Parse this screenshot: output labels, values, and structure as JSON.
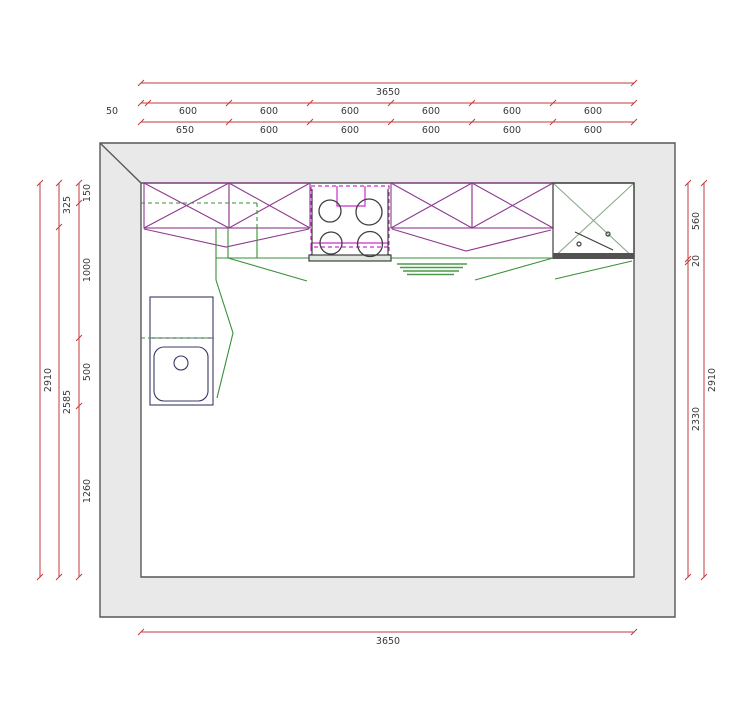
{
  "colors": {
    "dimension": "#c23b3b",
    "dim_text": "#3a3a3a",
    "wall_fill": "#e9e9e9",
    "wall_edge": "#575757",
    "cabinet": "#8e3a8e",
    "hood": "#cc2dcc",
    "fixture_green": "#3a8f3a",
    "hatch_green": "#4a9a4a",
    "tall_x_green": "#8aab8a",
    "appliance_dark": "#3f3f3f",
    "sink_navy": "#383864"
  },
  "dims": {
    "top_overall": "3650",
    "top_row2": [
      "50",
      "600",
      "600",
      "600",
      "600",
      "600",
      "600"
    ],
    "top_row3": [
      "650",
      "600",
      "600",
      "600",
      "600",
      "600"
    ],
    "bottom_overall": "3650",
    "left_inner": [
      "150",
      "1000",
      "500",
      "1260"
    ],
    "left_middle": [
      "325",
      "2585"
    ],
    "left_outer": "2910",
    "right_inner": [
      "560",
      "20",
      "2330"
    ],
    "right_outer": "2910"
  }
}
